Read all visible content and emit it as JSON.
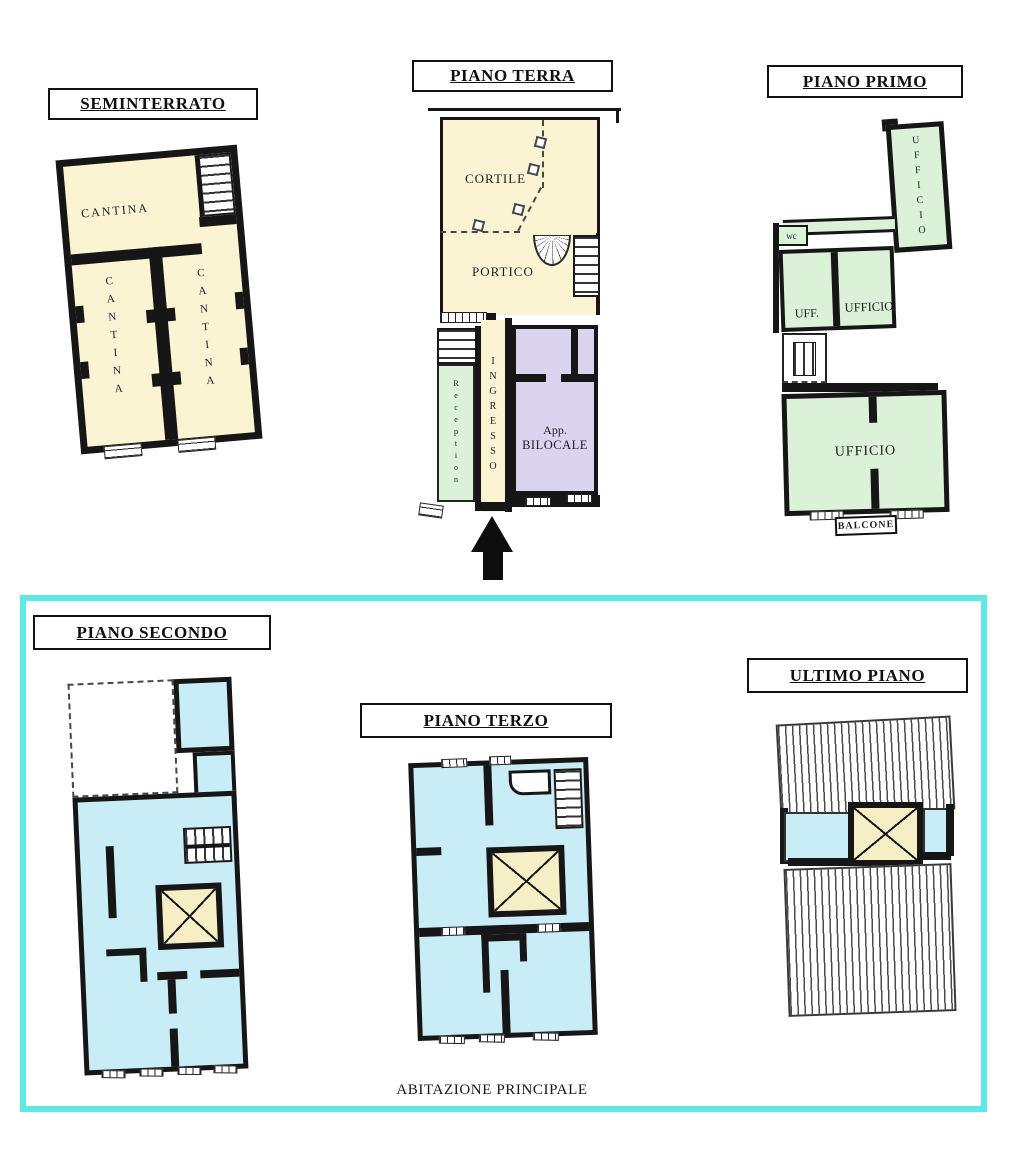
{
  "palette": {
    "cream": "#FBF4D2",
    "green": "#DCF2D8",
    "blue": "#C9EDF7",
    "lavender": "#DBD4EE",
    "lightwell": "#F6EFC6",
    "wall": "#161616",
    "highlight": "#5FE8E6",
    "ink": "#1b1b26"
  },
  "caption": "ABITAZIONE PRINCIPALE",
  "floors": {
    "seminterrato": {
      "title": "SEMINTERRATO",
      "cantina_top": "CANTINA",
      "cantina_left": "CANTINA",
      "cantina_right": "CANTINA"
    },
    "piano_terra": {
      "title": "PIANO TERRA",
      "cortile": "CORTILE",
      "portico": "PORTICO",
      "reception": "Reception",
      "ingresso": "INGRESSO",
      "bilocale_line1": "App.",
      "bilocale_line2": "BILOCALE"
    },
    "piano_primo": {
      "title": "PIANO PRIMO",
      "ufficio_tower": "UFFICIO",
      "wc": "wc",
      "uff": "UFF.",
      "ufficio_mid": "UFFICIO",
      "ufficio_main": "UFFICIO",
      "balcone": "BALCONE"
    },
    "piano_secondo": {
      "title": "PIANO SECONDO"
    },
    "piano_terzo": {
      "title": "PIANO TERZO"
    },
    "ultimo_piano": {
      "title": "ULTIMO PIANO"
    }
  }
}
